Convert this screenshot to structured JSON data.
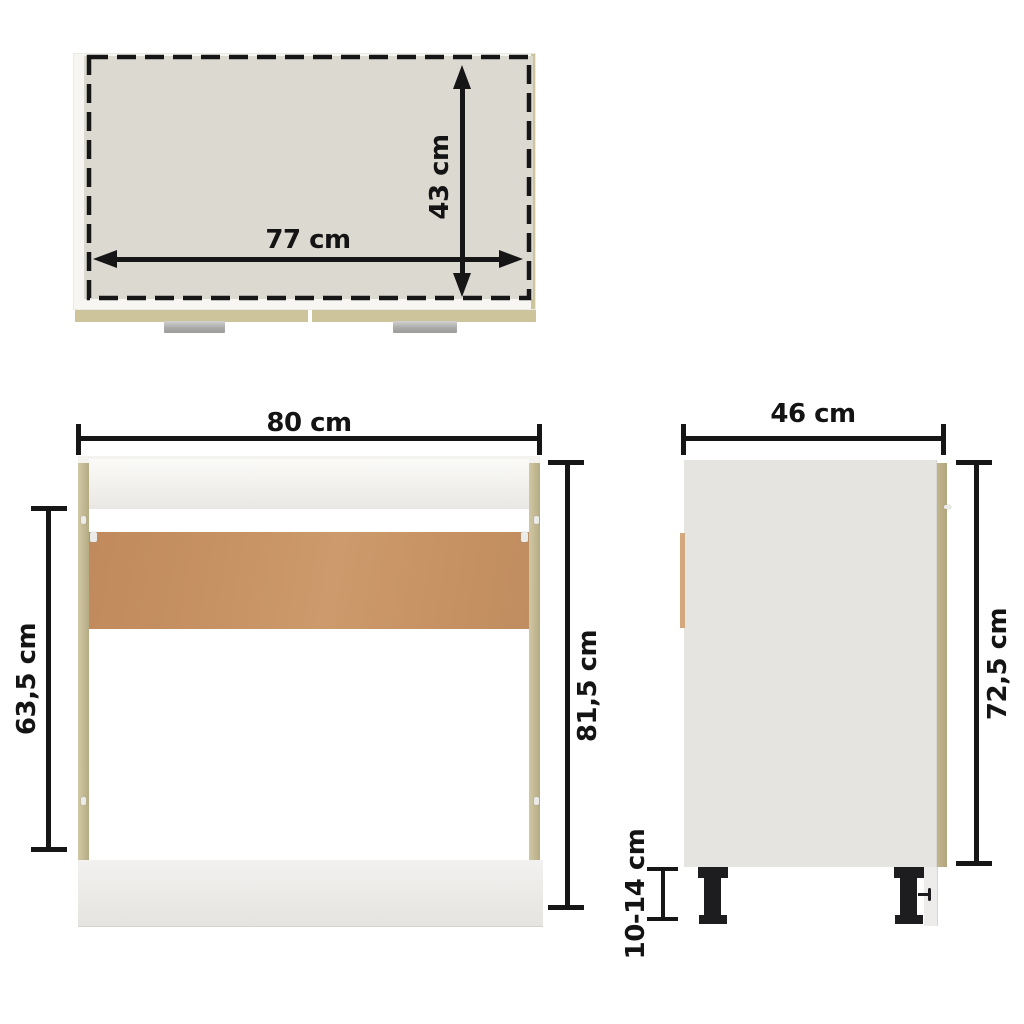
{
  "diagram_labels": {
    "top_view": {
      "width": "77 cm",
      "depth": "43 cm"
    },
    "front_view": {
      "width": "80 cm",
      "opening_height": "63,5 cm",
      "total_height": "81,5 cm"
    },
    "side_view": {
      "depth": "46 cm",
      "body_height": "72,5 cm",
      "leg_height": "10-14 cm"
    }
  },
  "colors": {
    "line": "#161616",
    "top-fill": "#dcd9d1",
    "white-panel": "#f7f6f3",
    "oak": "#c6bd97",
    "oak-dark": "#b0a57c",
    "backboard": "#c79263",
    "side-panel": "#e5e4e1",
    "bottom-panel": "#eeedea",
    "handle": "#ababa9",
    "leg": "#1d1d1f"
  }
}
